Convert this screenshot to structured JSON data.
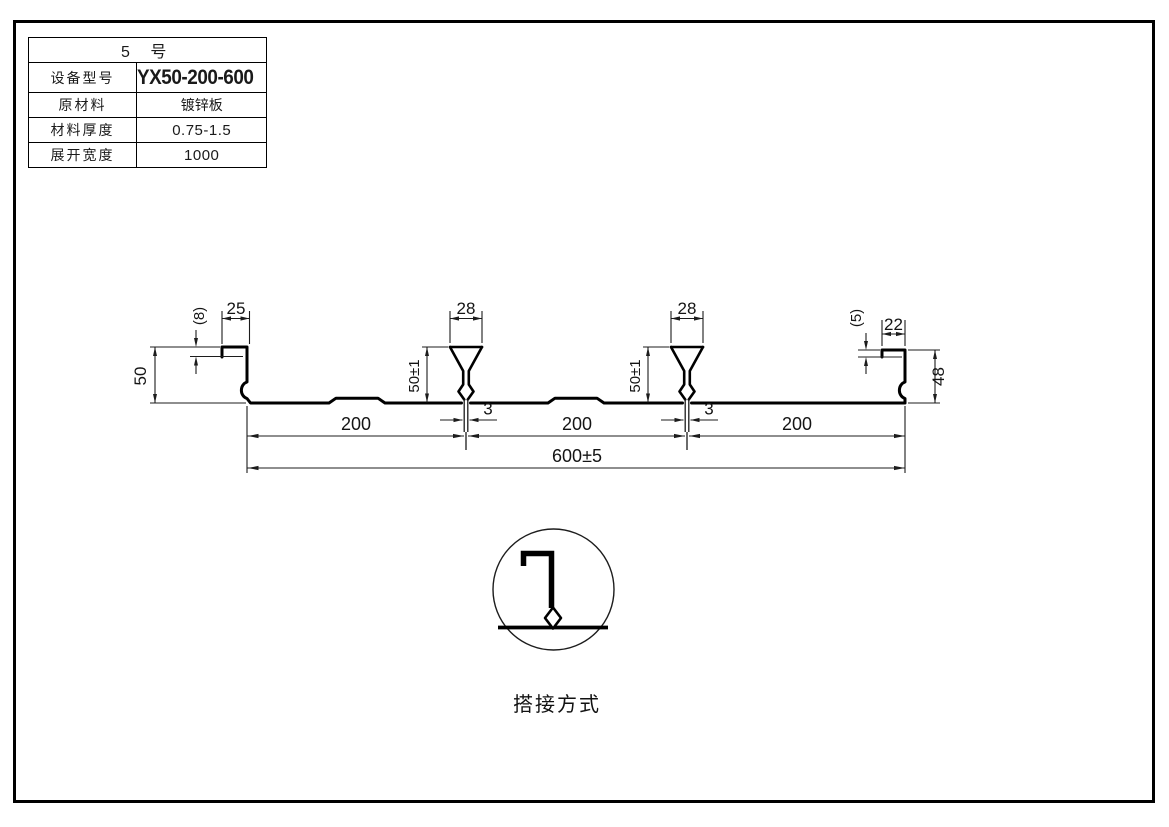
{
  "spec_table": {
    "title": "5 号",
    "rows": [
      {
        "label": "设备型号",
        "value": "YX50-200-600"
      },
      {
        "label": "原材料",
        "value": "镀锌板"
      },
      {
        "label": "材料厚度",
        "value": "0.75-1.5"
      },
      {
        "label": "展开宽度",
        "value": "1000"
      }
    ]
  },
  "drawing": {
    "dims": {
      "left_tab_width": "25",
      "left_edge_drop": "(8)",
      "left_height": "50",
      "rib_top_width": "28",
      "rib_height": "50±1",
      "rib_stem_width": "3",
      "pitch": "200",
      "overall_width": "600±5",
      "right_tab_width": "22",
      "right_edge_drop": "(5)",
      "right_height": "48"
    },
    "detail_caption": "搭接方式"
  },
  "colors": {
    "line": "#000000",
    "background": "#ffffff"
  }
}
